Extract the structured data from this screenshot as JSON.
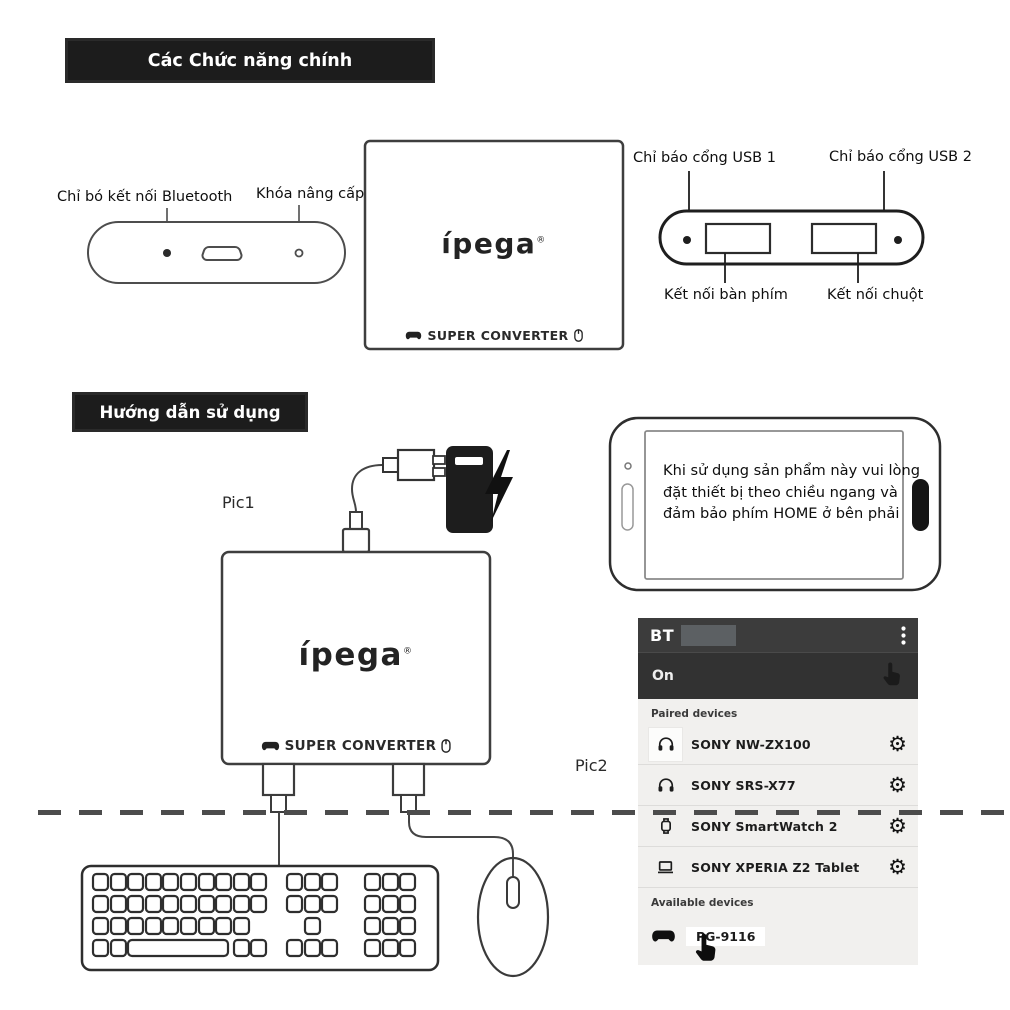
{
  "banners": {
    "main_functions": "Các Chức năng chính",
    "usage_guide": "Hướng dẫn sử dụng"
  },
  "function_diagram": {
    "bluetooth_indicator_label": "Chỉ bó kết nối Bluetooth",
    "upgrade_key_label": "Khóa nâng cấp",
    "usb1_indicator_label": "Chỉ báo cổng USB 1",
    "usb2_indicator_label": "Chỉ báo cổng USB 2",
    "keyboard_port_label": "Kết nối bàn phím",
    "mouse_port_label": "Kết nối chuột"
  },
  "device": {
    "logo": "ípega",
    "logo_mark": "®",
    "branding": "SUPER CONVERTER"
  },
  "pics": {
    "pic1": "Pic1",
    "pic2": "Pic2"
  },
  "phone_note_lines": {
    "line1": "Khi sử dụng sản phẩm này vui lòng",
    "line2": "đặt thiết bị theo chiều ngang và",
    "line3": "đảm bảo phím HOME ở bên phải"
  },
  "bt_settings": {
    "title": "BT",
    "toggle_state": "On",
    "paired_header": "Paired devices",
    "available_header": "Available devices",
    "gear_glyph": "⚙",
    "paired_devices": [
      {
        "name": "SONY NW-ZX100",
        "icon": "headphones"
      },
      {
        "name": "SONY SRS-X77",
        "icon": "headphones"
      },
      {
        "name": "SONY SmartWatch 2",
        "icon": "smartwatch"
      },
      {
        "name": "SONY XPERIA Z2 Tablet",
        "icon": "tablet"
      }
    ],
    "available_devices": [
      {
        "name": "PG-9116",
        "icon": "gamepad"
      }
    ]
  },
  "colors": {
    "banner_bg": "#1c1c1c",
    "bt_header_bg": "#3c3c3c",
    "bt_on_bg": "#323232",
    "bt_body_bg": "#f1f0ee",
    "line_art": "#3f3f3f"
  }
}
